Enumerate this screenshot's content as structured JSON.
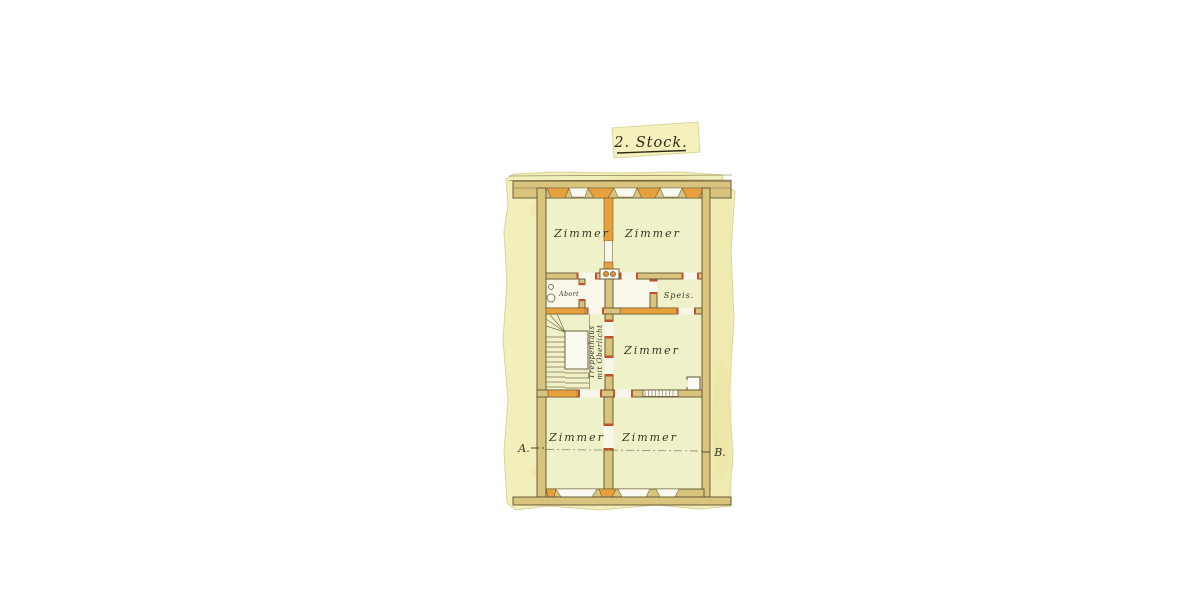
{
  "document": {
    "kind": "Scanned hand-drawn historic floor plan on aged yellow paper",
    "title": "2. Stock."
  },
  "floor_plan": {
    "rooms": [
      {
        "id": "room-top-left",
        "label": "Zimmer"
      },
      {
        "id": "room-top-right",
        "label": "Zimmer"
      },
      {
        "id": "room-middle-right",
        "label": "Zimmer"
      },
      {
        "id": "room-bottom-left",
        "label": "Zimmer"
      },
      {
        "id": "room-bottom-right",
        "label": "Zimmer"
      },
      {
        "id": "toilet",
        "label": "Abort"
      },
      {
        "id": "pantry",
        "label": "Speis."
      },
      {
        "id": "staircase",
        "label_line1": "Treppenhaus",
        "label_line2": "mit Oberlicht"
      }
    ],
    "section_markers": {
      "left": "A.",
      "right": "B."
    },
    "colors": {
      "paper": "#f3efba",
      "room_fill": "#eff1c9",
      "wall_tan": "#d9c47e",
      "brick_orange": "#e6a03e",
      "door_jamb_red": "#c2512f",
      "ink": "#3a3322"
    }
  }
}
